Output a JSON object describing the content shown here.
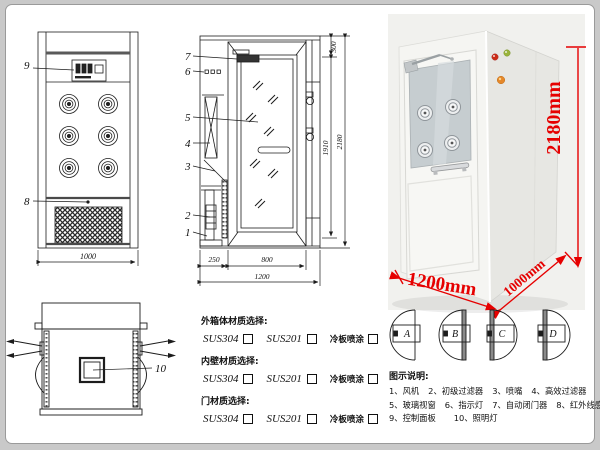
{
  "drawing": {
    "front": {
      "callout_9": "9",
      "callout_8": "8",
      "dim_width": "1000"
    },
    "side": {
      "callout_7": "7",
      "callout_6": "6",
      "callout_5": "5",
      "callout_4": "4",
      "callout_3": "3",
      "callout_2": "2",
      "callout_1": "1",
      "dim_top": "300",
      "dim_door_height": "1910",
      "dim_total_height": "2180",
      "dim_left": "250",
      "dim_door_width": "800",
      "dim_total_width": "1200"
    },
    "top": {
      "callout_10": "10"
    }
  },
  "photo": {
    "dim_height": "2180mm",
    "dim_width": "1200mm",
    "dim_depth": "1000mm"
  },
  "door_types": {
    "a": "A",
    "b": "B",
    "c": "C",
    "d": "D"
  },
  "materials": {
    "sections": [
      {
        "title": "外箱体材质选择:",
        "options": [
          "SUS304",
          "SUS201",
          "冷板喷涂"
        ]
      },
      {
        "title": "内壁材质选择:",
        "options": [
          "SUS304",
          "SUS201",
          "冷板喷涂"
        ]
      },
      {
        "title": "门材质选择:",
        "options": [
          "SUS304",
          "SUS201",
          "冷板喷涂"
        ]
      }
    ]
  },
  "legend": {
    "title": "图示说明:",
    "items": [
      "1、风机",
      "2、初级过滤器",
      "3、喷嘴",
      "4、高效过滤器",
      "5、玻璃视窗",
      "6、指示灯",
      "7、自动闭门器",
      "8、红外线感应器",
      "9、控制面板",
      "10、照明灯"
    ]
  },
  "colors": {
    "dimension_red": "#e60000",
    "line_black": "#1c1c1c"
  }
}
